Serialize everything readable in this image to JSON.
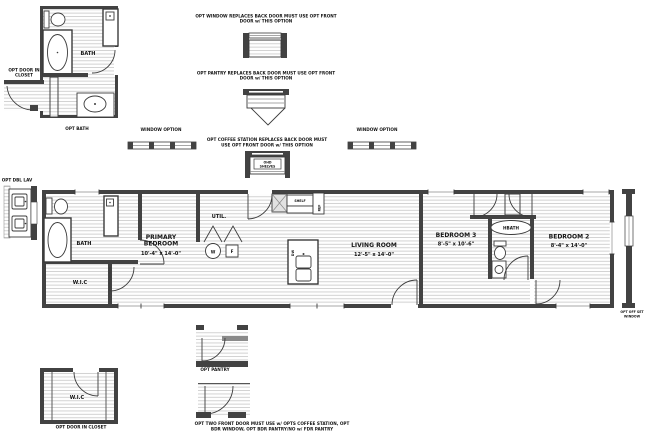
{
  "plan": {
    "rooms": {
      "bath": "BATH",
      "wic": "W.I.C",
      "primary_l1": "PRIMARY",
      "primary_l2": "BEDROOM",
      "primary_dims": "10'-4\" x 14'-0\"",
      "util": "UTIL.",
      "living": "LIVING ROOM",
      "living_dims": "12'-5\" x 14'-0\"",
      "bed3": "BEDROOM 3",
      "bed3_dims": "8'-5\" x 10'-6\"",
      "hbath": "HBATH",
      "bed2": "BEDROOM 2",
      "bed2_dims": "8'-4\" x 14'-0\""
    },
    "fixtures": {
      "washer": "W",
      "furnace": "F",
      "shelf": "SHELF",
      "ref": "REF",
      "dw": "DW"
    }
  },
  "options": {
    "window_note_l1": "OPT WINDOW REPLACES BACK DOOR MUST USE OPT FRONT",
    "window_note_l2": "DOOR w/ THIS OPTION",
    "pantry_note_l1": "OPT PANTRY REPLACES BACK DOOR MUST USE OPT FRONT",
    "pantry_note_l2": "DOOR w/ THIS OPTION",
    "coffee_note_l1": "OPT COFFEE STATION REPLACES BACK DOOR MUST",
    "coffee_note_l2": "USE OPT FRONT DOOR w/ THIS OPTION",
    "front_door_note_l1": "OPT TWO FRONT DOOR MUST USE w/ OPTS COFFEE STATION, OPT",
    "front_door_note_l2": "BDR WINDOW, OPT BDR PANTRY/NO w/ FDR PANTRY",
    "window_option_left": "WINDOW OPTION",
    "window_option_right": "WINDOW OPTION",
    "opt_bath_label": "OPT BATH",
    "opt_bath_room": "BATH",
    "opt_pantry": "OPT PANTRY",
    "opt_dbl_lav": "OPT DBL LAV",
    "opt_door_closet_top_l1": "OPT DOOR IN",
    "opt_door_closet_top_l2": "CLOSET",
    "opt_door_closet_bottom": "OPT DOOR IN CLOSET",
    "opt_offset_l1": "OPT OFF SET",
    "opt_offset_l2": "WINDOW",
    "coffee_box_l1": "OHD",
    "coffee_box_l2": "SHELVES",
    "wic_detail": "W.I.C"
  }
}
